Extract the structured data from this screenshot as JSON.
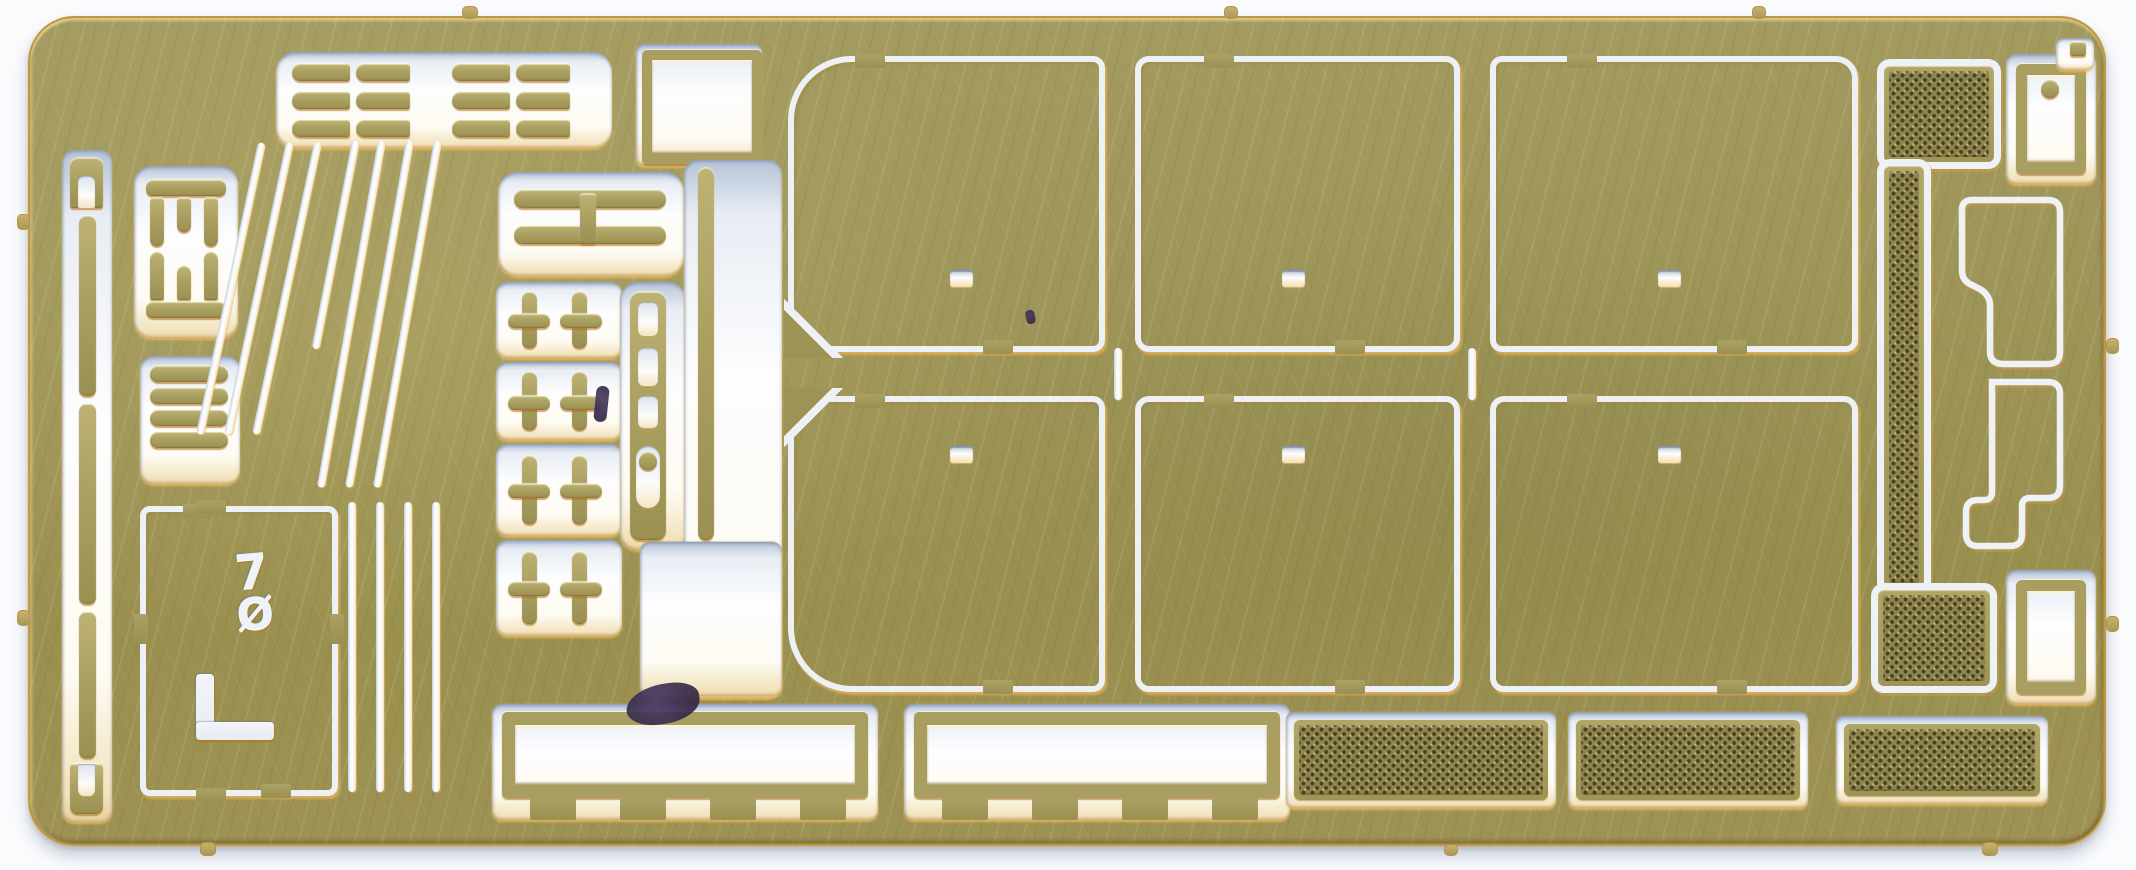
{
  "scene": {
    "description": "Flatbed scan of a photo-etched brass detail fret (scale-model parts sheet) on a white background",
    "sheet_marking": {
      "top_glyph": "7",
      "bottom_glyph": "Ø"
    },
    "bend_mark_shape": "L"
  },
  "colors": {
    "scanner_background": "#fafbfd",
    "brass_base": "#9d9457",
    "brass_highlight": "#e8cf8a",
    "brass_shadow": "#7c7440",
    "cut_edge_gold": "#e3a94f",
    "cut_shadow_blue": "#aebdd4",
    "cutout_white": "#fdfdfe",
    "mesh_base": "#8d8651",
    "mesh_dot": "#443e1c",
    "ink_stain": "#3a2d52"
  },
  "parts_inventory": {
    "top_left_hinge_bars": {
      "clusters": 2,
      "bars_per_cluster": 6
    },
    "left_edge_strip_segments": 3,
    "left_edge_end_brackets": 2,
    "comb_brackets": 2,
    "stacked_flat_bars": 4,
    "marked_square_panel": 1,
    "diagonal_strips": 6,
    "vertical_strips": 3,
    "double_bar_bracket": 1,
    "cross_brackets": 8,
    "clasp_strip_with_oval": 1,
    "framed_square_part": 1,
    "long_thin_strip": 1,
    "large_hatch_panels": {
      "count": 6,
      "rows": 2,
      "cols": 3,
      "hole_per_panel": 1
    },
    "mesh_l_screen": 1,
    "ring_plates": 2,
    "stepped_bracket": 1,
    "window_frames": 2,
    "mesh_grilles": 3,
    "sprue_edge_tabs": 10
  }
}
